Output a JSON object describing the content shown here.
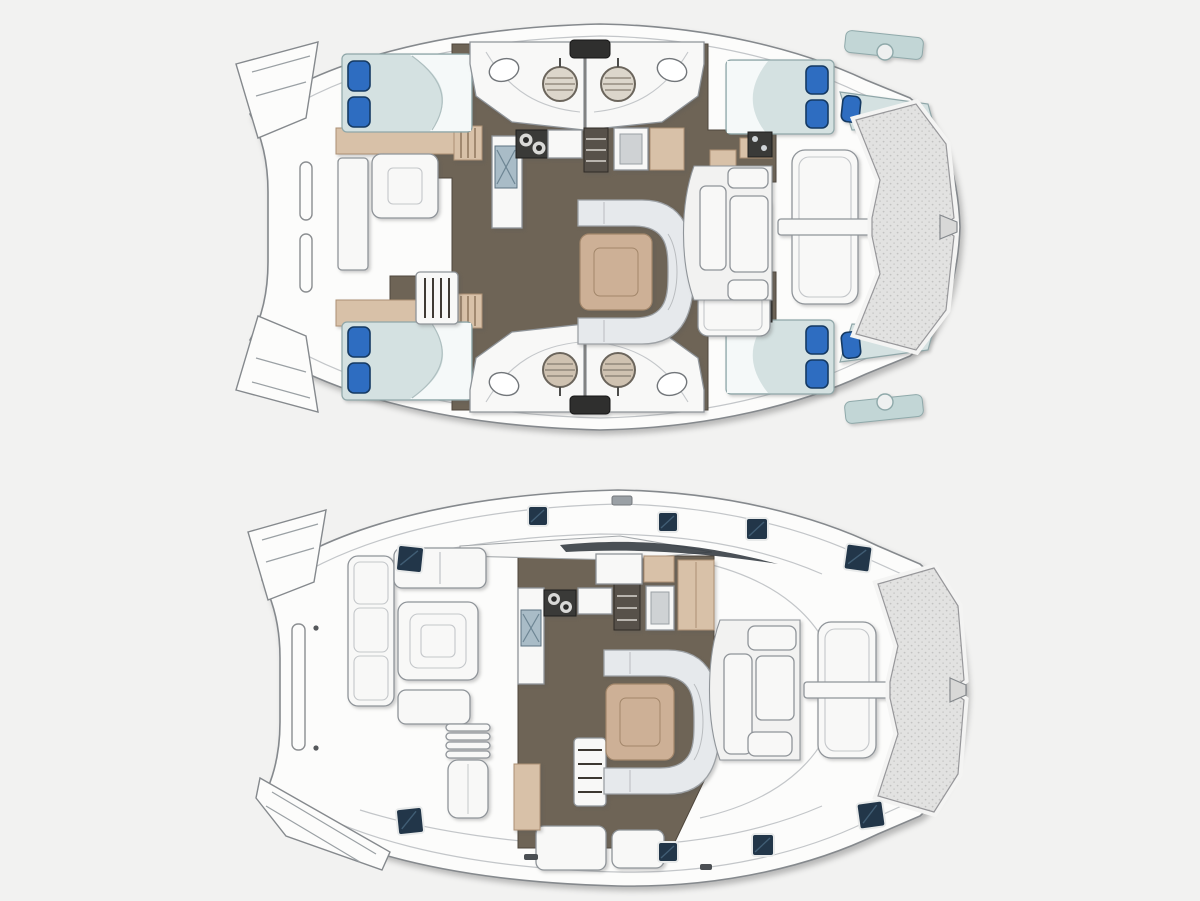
{
  "page": {
    "background": "#f2f2f1"
  },
  "image": {
    "type": "technical-drawing",
    "subject": "catamaran-yacht-deck-plans",
    "views": [
      {
        "id": "lower-deck-plan",
        "features": [
          "port aft cabin double bed",
          "port forward cabin",
          "starboard aft cabin double bed",
          "starboard forward cabin double bed",
          "two forepeak berths",
          "four bathrooms with round showers and toilets",
          "galley with stove, sink, fridge",
          "saloon table with curved sofa",
          "forward cockpit seating",
          "foredeck sunpads with walkway",
          "bow trampoline",
          "stern swim platforms"
        ]
      },
      {
        "id": "main-deck-plan",
        "features": [
          "aft cockpit dining table with L-sofa",
          "sun lounger chair",
          "companionway steps",
          "galley with stove and sink",
          "saloon table with curved sofa",
          "forward cockpit seating",
          "foredeck sunpad with walkway",
          "bow trampoline",
          "deck hatches",
          "swim platform with steps"
        ]
      }
    ]
  },
  "colors": {
    "bg": "#f2f2f1",
    "hullFill": "#fcfcfb",
    "hullStroke": "#85898d",
    "deckLine": "#c3c6c9",
    "floorDark": "#6e6456",
    "floorEdge": "#4e463c",
    "beige": "#d8c1a8",
    "beigeStroke": "#ac9074",
    "tableTan": "#cdb096",
    "tableStroke": "#a2866a",
    "sofaFill": "#e6e9ec",
    "sofaStroke": "#9da1a5",
    "furnWhite": "#f8f8f7",
    "furnStroke": "#8f9499",
    "mattress": "#d4e1e1",
    "mattressStroke": "#8fa6a8",
    "sheetWhite": "#f5f9f9",
    "pillowBlue": "#2e6dc1",
    "pillowStroke": "#153a63",
    "hatchNavy": "#223649",
    "hatchFrame": "#e8eaea",
    "hatchStreak": "#48687f",
    "meshFill": "#e2e2e1",
    "meshDot": "#c2c2c1",
    "meshEdge": "#97979a",
    "showerTop": "#dcd6cb",
    "showerBottom": "#cfc2b1",
    "showerLine": "#857d6f",
    "steel": "#a9bcc7",
    "darkAppliance": "#3a3a38",
    "stepDark": "#57514a",
    "teal": "#c2d6d6"
  }
}
